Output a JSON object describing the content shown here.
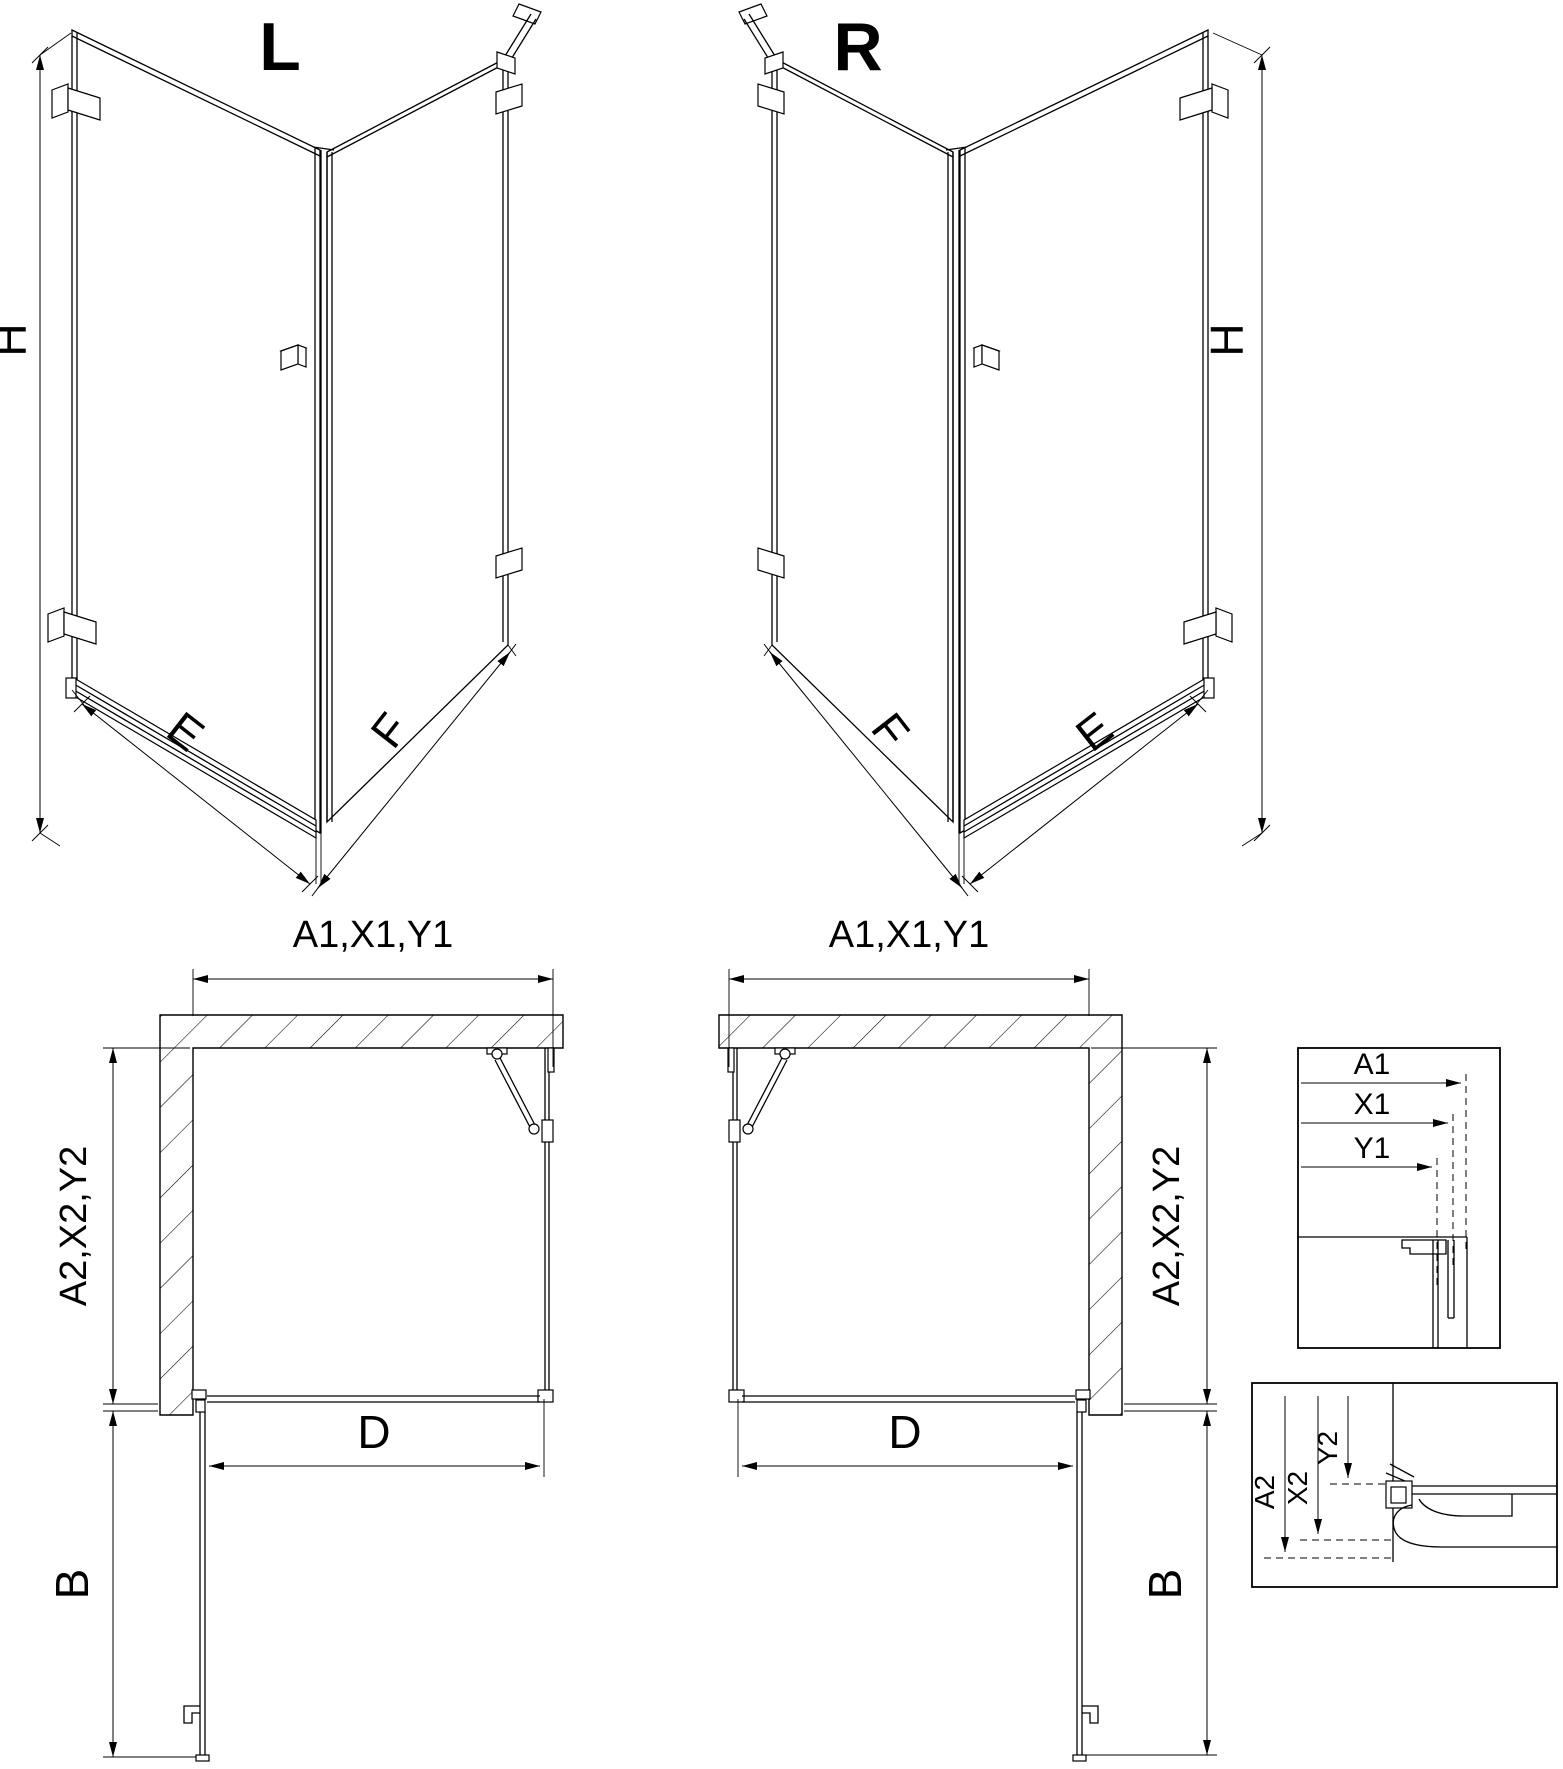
{
  "colors": {
    "ink": "#000000",
    "paper": "#ffffff"
  },
  "iso_left": {
    "title": "L",
    "dim_height": "H",
    "dim_door": "E",
    "dim_panel": "F"
  },
  "iso_right": {
    "title": "R",
    "dim_height": "H",
    "dim_door": "E",
    "dim_panel": "F"
  },
  "plan_left": {
    "dim_top": "A1,X1,Y1",
    "dim_side": "A2,X2,Y2",
    "dim_opening": "D",
    "dim_door_open": "B"
  },
  "plan_right": {
    "dim_top": "A1,X1,Y1",
    "dim_side": "A2,X2,Y2",
    "dim_opening": "D",
    "dim_door_open": "B"
  },
  "detail_top": {
    "a1": "A1",
    "x1": "X1",
    "y1": "Y1"
  },
  "detail_bottom": {
    "a2": "A2",
    "x2": "X2",
    "y2": "Y2"
  }
}
